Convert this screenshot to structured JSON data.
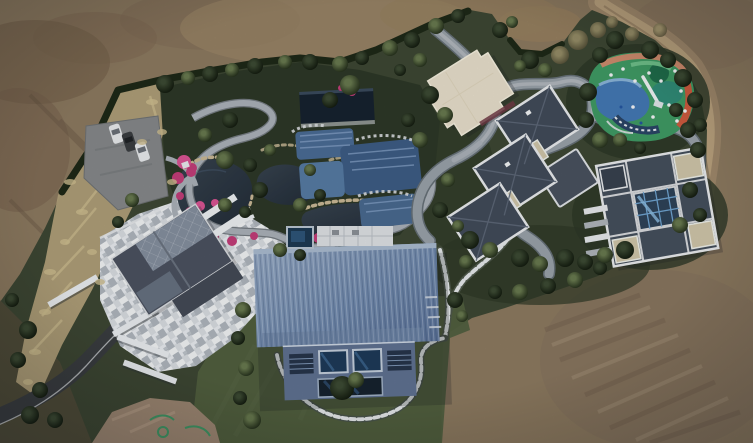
{
  "scene": {
    "type": "aerial-drone-photograph",
    "description": "Overhead drone view of a large landscaped private estate surrounded by bare brown earth. Inside the green compound: a big steel-blue corrugated barn-roof house, a stone-mosaic courtyard house with dark gabled glass roof, two grey hip-roofed villas with white parapets and beige flat sections, a cream flat-roofed hall, an ornamental pond garden with winding light stone paths, blue tiled pools, a dark pool pavilion and magenta flower beds, a multicoloured children's playground, a looping grey driveway, stepping-stone chain paths, a dark asphalt access road and a parking pad with three cars. A dirt track curves through the earth at top right.",
    "elements": [
      "bare-earth",
      "dirt-track",
      "boundary-hedge",
      "dry-grass-strip",
      "parking-pad",
      "cars",
      "pond-garden",
      "ponds",
      "flower-beds",
      "pool-pavilion",
      "tiled-pools",
      "garden-paths",
      "driveway-loop",
      "stepping-stone-paths",
      "cream-flat-roof-hall",
      "stepped-grey-villa",
      "atrium-villa",
      "courtyard-house",
      "stone-courtyard",
      "white-walls",
      "asphalt-road",
      "blue-barn-house",
      "spa-pool",
      "terrace",
      "playground",
      "trees",
      "lawn",
      "paint-marks"
    ],
    "palette": {
      "dirt_base": "#8c7960",
      "dirt_dark": "#6f5b46",
      "dirt_light": "#9d8768",
      "dirt_track": "#b49c7b",
      "estate_green": "#3d4733",
      "lawn_green": "#51603f",
      "garden_bed": "#2d3827",
      "hedge_dark": "#1e2817",
      "dry_grass": "#b3a27b",
      "water_dark": "#2b3540",
      "path_gray": "#aab1b8",
      "driveway_gray": "#99a2a9",
      "stone_white": "#e9ecef",
      "asphalt": "#3a3d40",
      "roof_dark": "#434d5a",
      "roof_parapet": "#e6e8ea",
      "roof_beige": "#cfc5a9",
      "cream_roof": "#e7decb",
      "barn_blue": "#7189ac",
      "facade_blue": "#5f7190",
      "glass_navy": "#1e3a58",
      "playground_green": "#3f9a64",
      "playground_blue": "#4478b4",
      "playground_orange": "#cd5a3e",
      "playground_navy": "#2a4566",
      "flower_pink": "#c23d78",
      "pool_tile": "#4a6b94",
      "car_white": "#e8eaec",
      "car_dark": "#3a3d40",
      "mark_green": "#3f9464"
    }
  }
}
